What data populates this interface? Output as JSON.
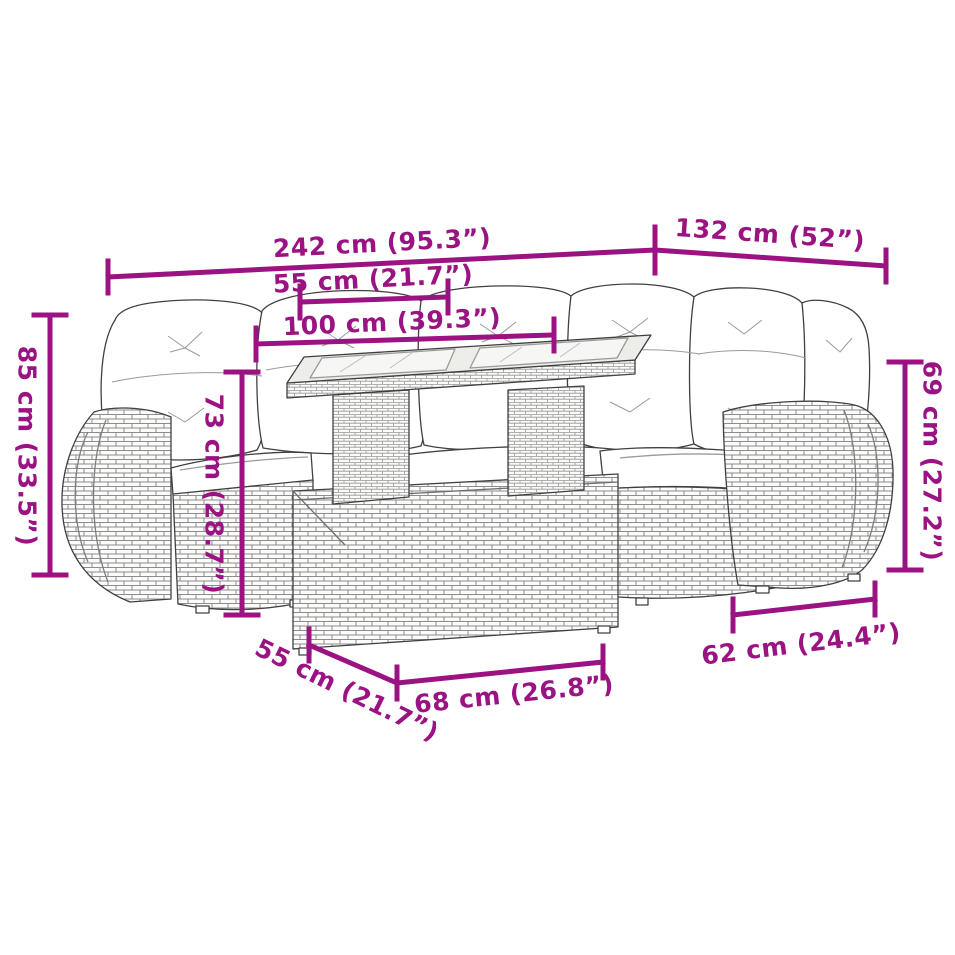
{
  "diagram": {
    "kind": "product-dimension-diagram",
    "subject": "rattan-corner-sofa-set-with-table"
  },
  "colors": {
    "dimension_accent": "#9B1283",
    "line_art": "#404040",
    "background": "#FFFFFF"
  },
  "dimensions": {
    "total_width": {
      "label": "242 cm (95.3”)",
      "cm": 242,
      "inches": 95.3
    },
    "right_width": {
      "label": "132 cm (52”)",
      "cm": 132,
      "inches": 52
    },
    "seat_width_top": {
      "label": "55 cm (21.7”)",
      "cm": 55,
      "inches": 21.7
    },
    "table_length": {
      "label": "100 cm (39.3”)",
      "cm": 100,
      "inches": 39.3
    },
    "back_height": {
      "label": "85 cm (33.5”)",
      "cm": 85,
      "inches": 33.5
    },
    "table_height": {
      "label": "73 cm (28.7”)",
      "cm": 73,
      "inches": 28.7
    },
    "right_height": {
      "label": "69 cm (27.2”)",
      "cm": 69,
      "inches": 27.2
    },
    "right_depth": {
      "label": "62 cm (24.4”)",
      "cm": 62,
      "inches": 24.4
    },
    "left_depth": {
      "label": "55 cm (21.7”)",
      "cm": 55,
      "inches": 21.7
    },
    "front_width": {
      "label": "68 cm (26.8”)",
      "cm": 68,
      "inches": 26.8
    }
  }
}
